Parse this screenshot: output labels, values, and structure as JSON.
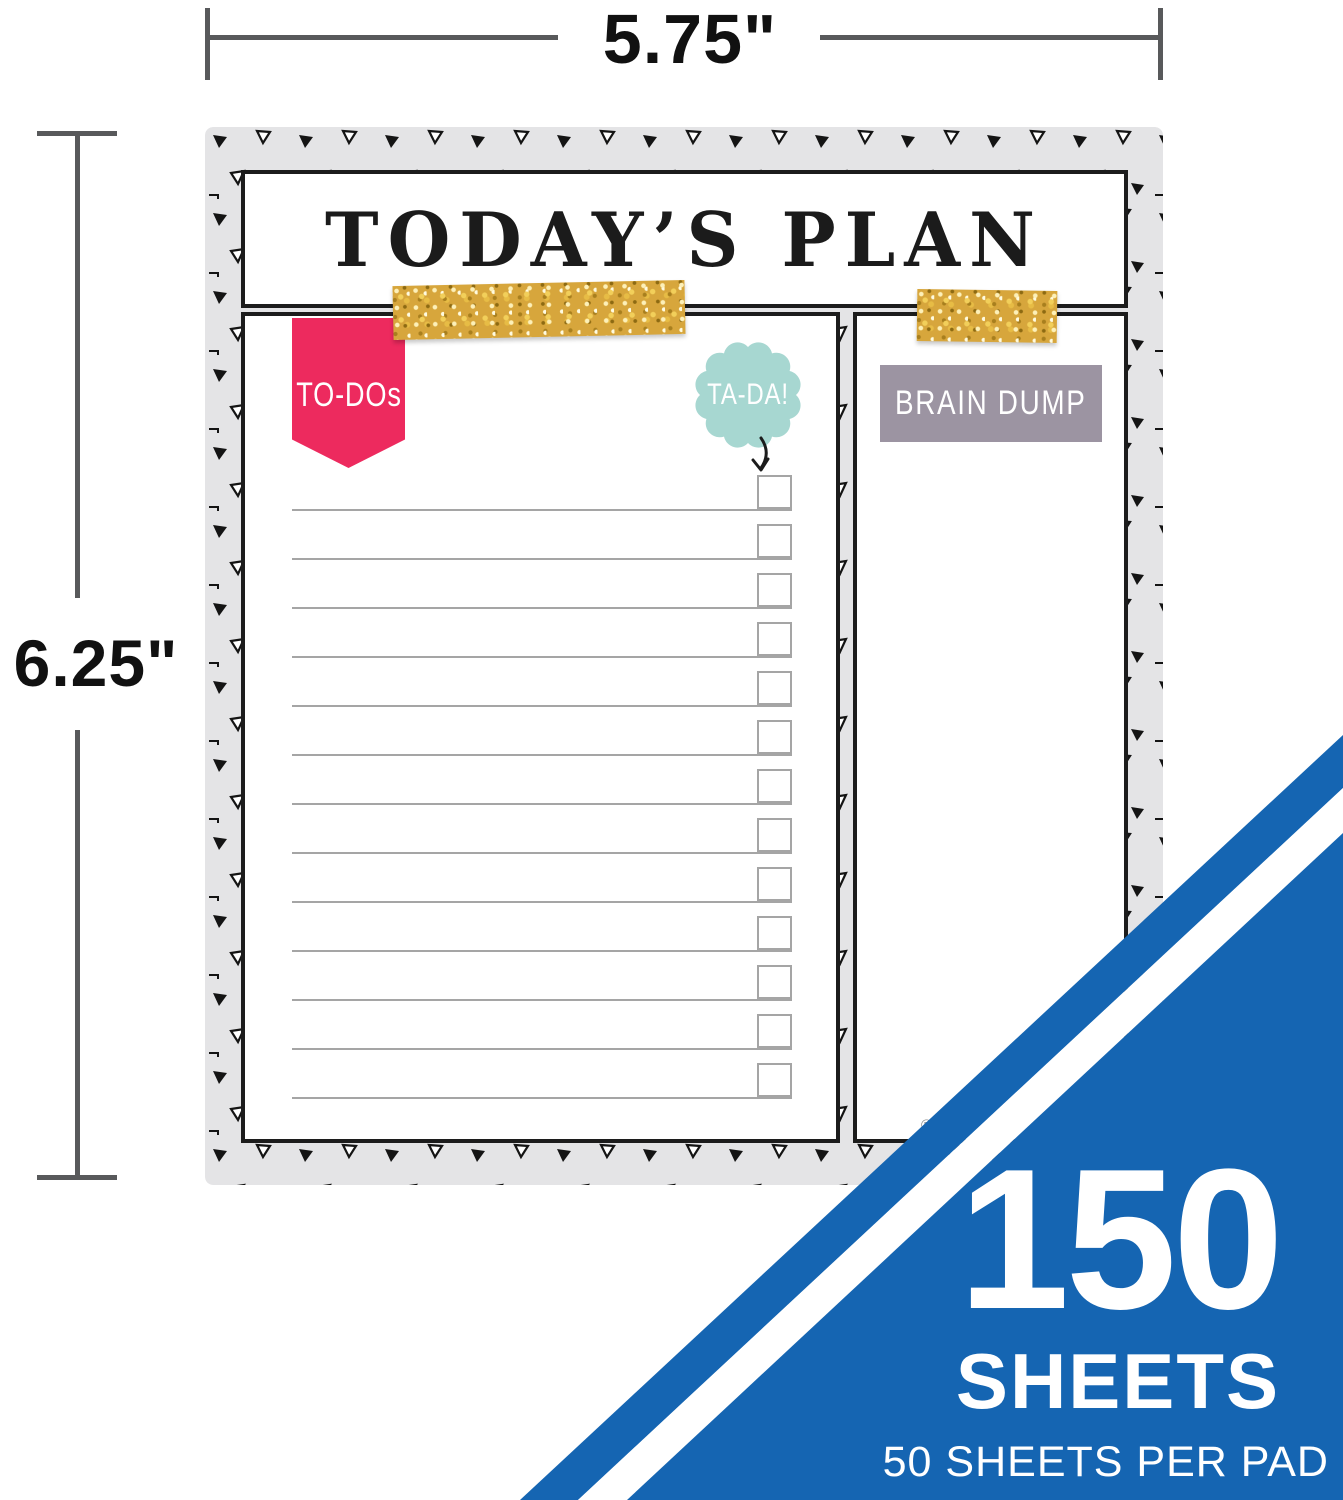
{
  "dimension_annotations": {
    "width_label": "5.75\"",
    "height_label": "6.25\""
  },
  "pad": {
    "title": "TODAY’S PLAN",
    "todo_banner_label": "TO-DOs",
    "tada_badge_label": "TA-DA!",
    "brain_dump_label": "BRAIN DUMP",
    "registered_mark": "®",
    "todo_list": {
      "row_count": 13,
      "rows_blank": true
    }
  },
  "corner_banner": {
    "count": "150",
    "unit": "SHEETS",
    "detail": "50 SHEETS PER PAD"
  },
  "colors": {
    "pink": "#ED2A5E",
    "teal": "#A7D7D1",
    "label-gray": "#9C94A2",
    "blue": "#1565B2",
    "gold": "#D7A63C",
    "pad-gray": "#E4E4E6",
    "dimline": "#58595B"
  }
}
